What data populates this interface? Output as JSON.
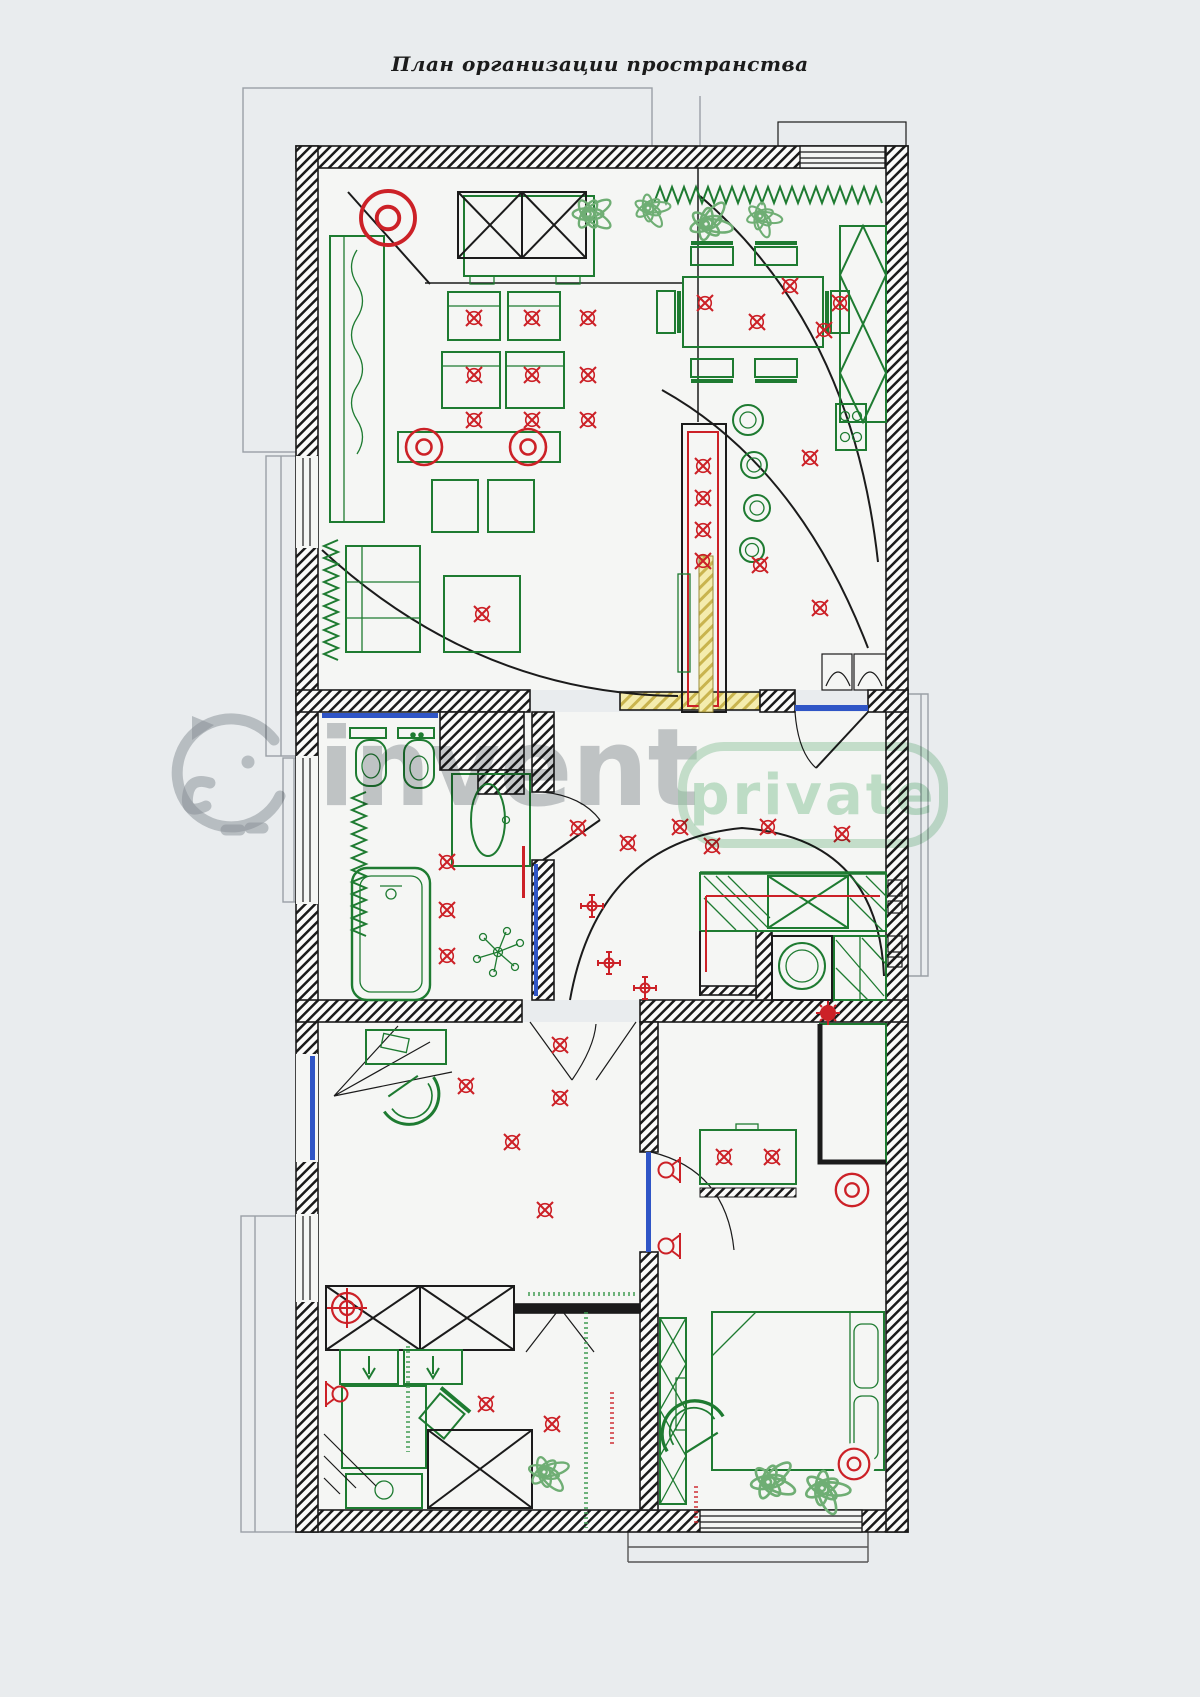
{
  "page": {
    "title": "План организации пространства"
  },
  "watermark": {
    "brand": "invent",
    "badge": "private",
    "logo": "elephant-logo"
  },
  "drawing": {
    "type": "apartment-floor-plan-with-lighting-layout",
    "colors": {
      "walls": "#1b1b1b",
      "furniture_green": "#1e7b31",
      "lighting_red": "#cc2127",
      "doors_windows_blue": "#2f55c6",
      "structural_yellow": "#e8dd96",
      "plants_green": "#6fae74",
      "watermark_gray": "#969ca2",
      "watermark_green": "#9ed0ac",
      "paper": "#e9ecee"
    },
    "symbols": [
      "ceiling-spot-light-icon",
      "chandelier-icon",
      "pendant-cross-light-icon",
      "wall-sconce-icon",
      "surface-light-icon",
      "track-target-light-icon",
      "door-swing-icon",
      "radiator-zigzag-icon",
      "plant-icon"
    ]
  }
}
